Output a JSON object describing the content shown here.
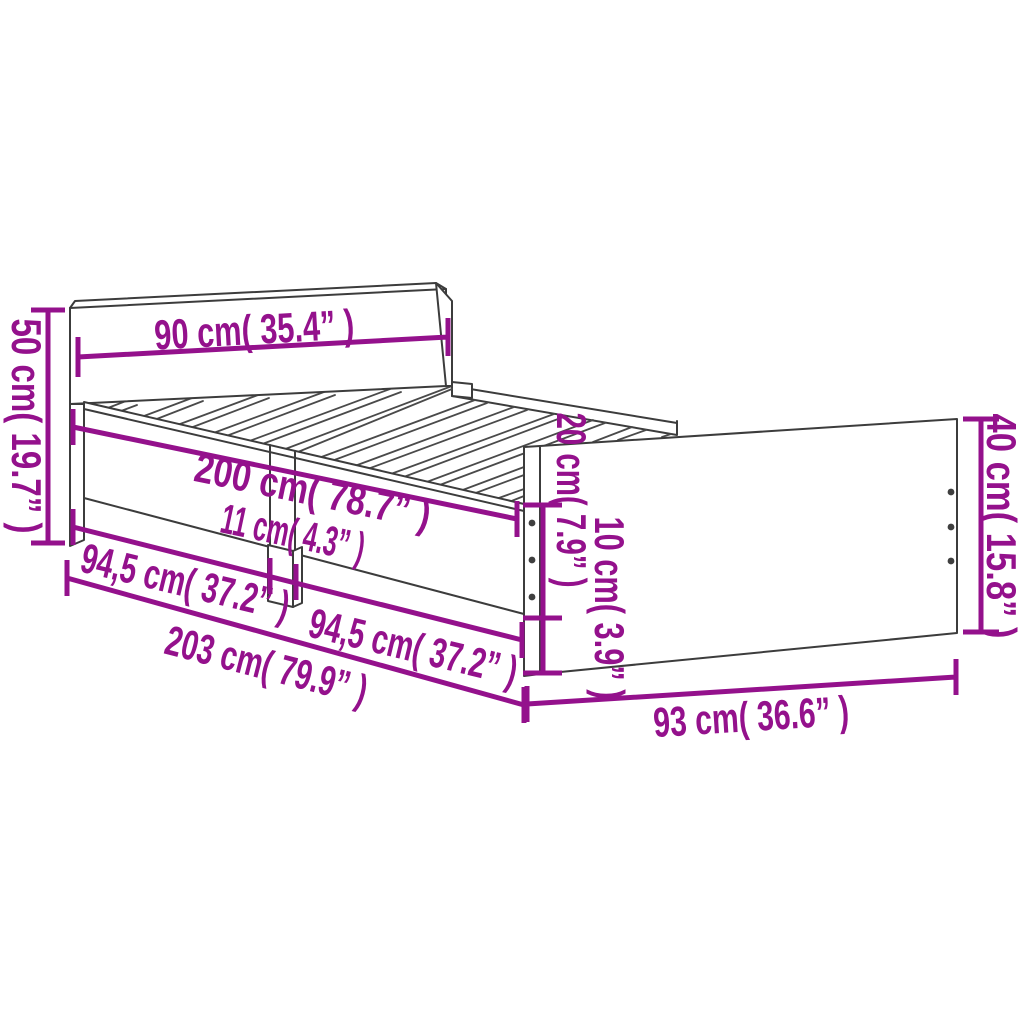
{
  "diagram": {
    "colors": {
      "background": "#ffffff",
      "drawing_line": "#3c3c3c",
      "dimension_accent": "#94118C"
    },
    "dimensions": {
      "headboard_width": "90 cm( 35.4” )",
      "headboard_height": "50 cm( 19.7” )",
      "bed_length": "200 cm( 78.7” )",
      "middle_leg_width": "11 cm( 4.3” )",
      "left_leg_span": "94,5 cm( 37.2” )",
      "right_leg_span": "94,5 cm( 37.2” )",
      "total_length": "203 cm( 79.9” )",
      "side_rail_height": "20 cm( 7.9” )",
      "leg_height": "10 cm( 3.9” )",
      "footboard_height": "40 cm( 15.8” )",
      "footboard_width": "93 cm( 36.6” )"
    }
  }
}
